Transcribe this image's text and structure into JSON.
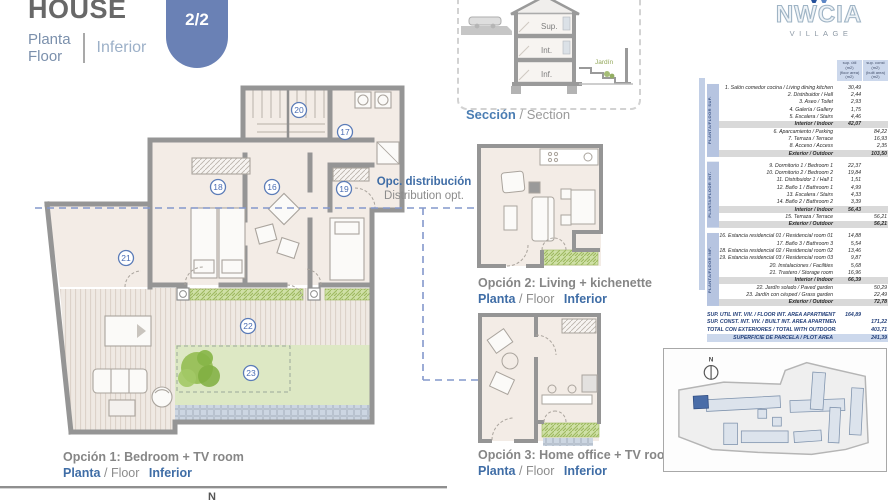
{
  "header": {
    "title": "HOUSE",
    "planta": "Planta",
    "floor": "Floor",
    "level": "Inferior"
  },
  "badge": {
    "number": "08",
    "pages": "2/2"
  },
  "section": {
    "sup": "Sup.",
    "int": "Int.",
    "inf": "Inf.",
    "jardin": "Jardín",
    "caption_es": "Sección",
    "caption_en": "/ Section"
  },
  "logo": {
    "brand": "NWCIA",
    "sub": "VILLAGE"
  },
  "distribution_note": {
    "es": "Opc. distribución",
    "en": "Distribution opt."
  },
  "plan": {
    "rooms": {
      "r16": "16",
      "r17": "17",
      "r18": "18",
      "r19": "19",
      "r20": "20",
      "r21": "21",
      "r22": "22",
      "r23": "23"
    }
  },
  "options": {
    "opt1": {
      "title": "Opción 1: Bedroom + TV room",
      "planta": "Planta",
      "floor": "/ Floor",
      "level": "Inferior"
    },
    "opt2": {
      "title": "Opción 2: Living + kichenette",
      "planta": "Planta",
      "floor": "/ Floor",
      "level": "Inferior"
    },
    "opt3": {
      "title": "Opción 3: Home office + TV room",
      "planta": "Planta",
      "floor": "/ Floor",
      "level": "Inferior"
    }
  },
  "areas_table": {
    "col1_header": [
      "sup. útil",
      "(m2)",
      "(floor area)",
      "(m2)"
    ],
    "col2_header": [
      "sup. const",
      "(m2)",
      "(built area)",
      "(m2)"
    ],
    "groups": [
      {
        "label": "PLANTA/FLOOR SUP.",
        "rows": [
          {
            "name": "1. Salón comedor cocina / Living dining kitchen",
            "c1": "30,49"
          },
          {
            "name": "2. Distribuidor / Hall",
            "c1": "2,44"
          },
          {
            "name": "3. Aseo / Toilet",
            "c1": "2,93"
          },
          {
            "name": "4. Galería / Gallery",
            "c1": "1,75"
          },
          {
            "name": "5. Escalera / Stairs",
            "c1": "4,46"
          },
          {
            "name": "Interior / Indoor",
            "c1": "42,07",
            "subtotal": true
          },
          {
            "name": "6. Aparcamiento / Parking",
            "c2": "84,22"
          },
          {
            "name": "7. Terraza / Terrace",
            "c2": "16,93"
          },
          {
            "name": "8. Acceso / Access",
            "c2": "2,35"
          },
          {
            "name": "Exterior / Outdoor",
            "c2": "103,50",
            "subtotal": true
          }
        ]
      },
      {
        "label": "PLANTA/FLOOR INT.",
        "rows": [
          {
            "name": "9. Dormitorio 1 / Bedroom 1",
            "c1": "22,37"
          },
          {
            "name": "10. Dormitorio 2 / Bedroom 2",
            "c1": "19,84"
          },
          {
            "name": "11. Distribuidor 1 / Hall 1",
            "c1": "1,51"
          },
          {
            "name": "12. Baño 1 / Bathroom 1",
            "c1": "4,99"
          },
          {
            "name": "13. Escalera / Stairs",
            "c1": "4,33"
          },
          {
            "name": "14. Baño 2 / Bathroom 2",
            "c1": "3,39"
          },
          {
            "name": "Interior / Indoor",
            "c1": "56,43",
            "subtotal": true
          },
          {
            "name": "15. Terraza / Terrace",
            "c2": "56,21"
          },
          {
            "name": "Exterior / Outdoor",
            "c2": "56,21",
            "subtotal": true
          }
        ]
      },
      {
        "label": "PLANTA/FLOOR INF.",
        "rows": [
          {
            "name": "16. Estancia residencial 01 / Residencial room 01",
            "c1": "14,88"
          },
          {
            "name": "17. Baño 3 / Bathroom 3",
            "c1": "5,54"
          },
          {
            "name": "18. Estancia residencial 02 / Residencial room 02",
            "c1": "13,46"
          },
          {
            "name": "19. Estancia residencial 03 / Residencial room 03",
            "c1": "9,87"
          },
          {
            "name": "20. Instalaciones / Facilities",
            "c1": "5,68"
          },
          {
            "name": "21. Trastero / Storage room",
            "c1": "16,96"
          },
          {
            "name": "Interior / Indoor",
            "c1": "66,39",
            "subtotal": true
          },
          {
            "name": "22. Jardín solado / Paved garden",
            "c2": "50,29"
          },
          {
            "name": "23. Jardín con césped / Grass garden",
            "c2": "22,49"
          },
          {
            "name": "Exterior / Outdoor",
            "c2": "72,78",
            "subtotal": true
          }
        ]
      }
    ],
    "summary": [
      {
        "name": "SUP. ÚTIL INT. VIV. / FLOOR INT. AREA APARTMENT",
        "c1": "164,89"
      },
      {
        "name": "SUP. CONST. INT. VIV. / BUILT INT. AREA APARTMENT",
        "c2": "171,22"
      },
      {
        "name": "TOTAL CON EXTERIORES / TOTAL WITH OUTDOORS",
        "c2": "403,71"
      },
      {
        "name": "SUPERFICIE DE PARCELA / PLOT AREA",
        "c2": "241,39"
      }
    ]
  },
  "sitemap": {
    "north": "N"
  },
  "north_label": "N",
  "colors": {
    "accent_blue": "#3f6da6",
    "badge_blue": "#6a81b5",
    "wall_gray": "#959595",
    "grass_green": "#dde8c4",
    "plant_green": "#8fbc4f"
  }
}
